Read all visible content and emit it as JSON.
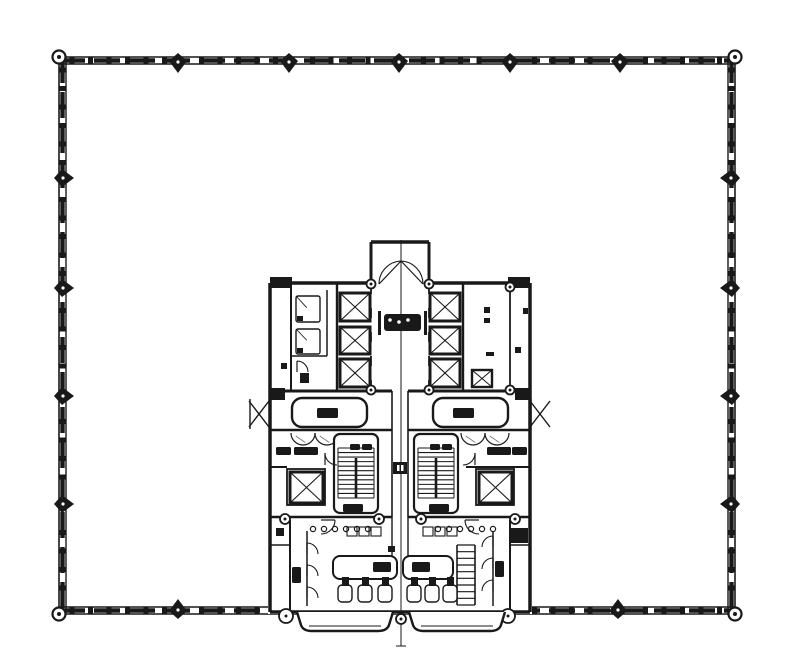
{
  "document": {
    "type": "architectural-floor-plan",
    "description": "Scanned typical office tower floor plan: square floor plate with curtain-wall perimeter and a bottom-center service core (elevator banks, stairs, restrooms)",
    "background": "#ffffff",
    "ink": "#191919",
    "light_ink": "#6f6f6f"
  },
  "perimeter": {
    "outer": {
      "x": 59,
      "y": 57,
      "w": 676,
      "h": 557
    },
    "band_inset": 7,
    "dash": {
      "len": 26,
      "gap": 9,
      "w": 4.4
    },
    "tick": {
      "spacing": 18.5,
      "w": 5,
      "h": 3.2
    },
    "corner_nodes": [
      [
        59,
        57
      ],
      [
        735,
        57
      ],
      [
        59,
        614
      ],
      [
        735,
        614
      ]
    ],
    "columns": {
      "top": [
        178,
        289,
        399,
        510,
        620
      ],
      "bottom": [
        178,
        618
      ],
      "left": [
        178,
        288,
        396,
        504
      ],
      "right": [
        178,
        288,
        396,
        504
      ]
    },
    "column_size": 9
  },
  "core": {
    "fill_rects": [
      [
        268,
        281,
        264,
        333
      ],
      [
        369,
        240,
        66,
        45
      ],
      [
        247,
        397,
        25,
        34
      ],
      [
        530,
        397,
        25,
        34
      ]
    ],
    "centerline": {
      "x": 401,
      "y1": 240,
      "y2": 646
    },
    "walls": [
      [
        270,
        283,
        371,
        283,
        3.5
      ],
      [
        429,
        283,
        530,
        283,
        3.5
      ],
      [
        270,
        283,
        270,
        612,
        3.5
      ],
      [
        530,
        283,
        530,
        612,
        3.5
      ],
      [
        270,
        612,
        530,
        612,
        3.5
      ],
      [
        371,
        242,
        371,
        284,
        3
      ],
      [
        429,
        242,
        429,
        284,
        3
      ],
      [
        371,
        242,
        429,
        242,
        3.5
      ],
      [
        291,
        283,
        291,
        391,
        2
      ],
      [
        327,
        290,
        327,
        356,
        1.5
      ],
      [
        291,
        356,
        327,
        356,
        1.5
      ],
      [
        337,
        283,
        337,
        391,
        2.4
      ],
      [
        463,
        283,
        463,
        391,
        2.4
      ],
      [
        510,
        283,
        510,
        391,
        1.8
      ],
      [
        270,
        391,
        392,
        391,
        3
      ],
      [
        408,
        391,
        530,
        391,
        3
      ],
      [
        270,
        430,
        392,
        430,
        2.6
      ],
      [
        408,
        430,
        530,
        430,
        2.6
      ],
      [
        392,
        391,
        392,
        517,
        1.6
      ],
      [
        408,
        391,
        408,
        517,
        1.6
      ],
      [
        270,
        467,
        287,
        467,
        2
      ],
      [
        466,
        467,
        530,
        467,
        2
      ],
      [
        270,
        517,
        392,
        517,
        2.6
      ],
      [
        408,
        517,
        530,
        517,
        2.6
      ],
      [
        290,
        520,
        290,
        612,
        2
      ],
      [
        307,
        531,
        307,
        606,
        1.5
      ],
      [
        493,
        531,
        493,
        606,
        1.5
      ],
      [
        510,
        520,
        510,
        612,
        2
      ],
      [
        270,
        545,
        290,
        545,
        1.5
      ],
      [
        510,
        545,
        530,
        545,
        1.5
      ],
      [
        392,
        517,
        392,
        556,
        1.4
      ],
      [
        408,
        517,
        408,
        556,
        1.4
      ]
    ],
    "dashed_walls": [
      [
        371,
        284,
        371,
        390,
        1.8,
        "10 14"
      ],
      [
        429,
        284,
        429,
        390,
        1.8,
        "10 14"
      ]
    ],
    "posts": [
      [
        270,
        277,
        22,
        11
      ],
      [
        508,
        277,
        22,
        11
      ],
      [
        270,
        388,
        15,
        12
      ],
      [
        515,
        388,
        15,
        12
      ],
      [
        509,
        528,
        19,
        15
      ]
    ],
    "rings": [
      [
        371,
        284,
        4.5
      ],
      [
        429,
        284,
        4.5
      ],
      [
        371,
        390,
        4.5
      ],
      [
        429,
        390,
        4.5
      ],
      [
        510,
        287,
        4.5
      ],
      [
        510,
        390,
        4.5
      ],
      [
        285,
        519,
        5
      ],
      [
        379,
        519,
        5
      ],
      [
        421,
        519,
        5
      ],
      [
        515,
        519,
        5
      ],
      [
        286,
        616,
        7
      ],
      [
        401,
        619,
        5
      ],
      [
        508,
        616,
        7
      ]
    ],
    "elevators": [
      [
        340,
        293,
        30,
        28
      ],
      [
        340,
        327,
        30,
        27
      ],
      [
        340,
        359,
        30,
        28
      ],
      [
        430,
        293,
        30,
        28
      ],
      [
        430,
        327,
        30,
        27
      ],
      [
        430,
        359,
        30,
        28
      ],
      [
        290,
        472,
        33,
        31
      ],
      [
        479,
        472,
        33,
        31
      ]
    ],
    "enclosures": [
      [
        287,
        469,
        38,
        36
      ],
      [
        476,
        469,
        38,
        36
      ]
    ],
    "shaft_panels": [
      [
        296,
        296,
        24,
        26
      ],
      [
        296,
        329,
        24,
        25
      ]
    ],
    "duct_xboxes": [
      [
        472,
        370,
        20,
        17
      ]
    ],
    "stairs": [
      {
        "x": 334,
        "y": 434,
        "w": 44,
        "h": 79,
        "tx1": 338,
        "tx2": 374,
        "ty1": 448,
        "ty2": 498,
        "n": 12
      },
      {
        "x": 414,
        "y": 434,
        "w": 44,
        "h": 79,
        "tx1": 418,
        "tx2": 454,
        "ty1": 448,
        "ty2": 498,
        "n": 12
      }
    ],
    "ladder": {
      "x": 457,
      "y": 545,
      "w": 18,
      "h": 60,
      "rungs": 9
    },
    "rounded_rooms": [
      [
        292,
        398,
        75,
        29
      ],
      [
        433,
        398,
        75,
        29
      ]
    ],
    "counters": [
      [
        333,
        556,
        64,
        23
      ],
      [
        403,
        556,
        50,
        23
      ]
    ],
    "toilets": {
      "y": 585,
      "w": 14,
      "h": 17,
      "xs": [
        338,
        358,
        378,
        407,
        425,
        443
      ]
    },
    "badge": {
      "bracket_l": [
        378,
        311,
        3,
        24
      ],
      "bracket_r": [
        424,
        311,
        3,
        24
      ],
      "inner": [
        384,
        314,
        37,
        17
      ],
      "dots": [
        [
          390,
          320
        ],
        [
          399,
          322
        ],
        [
          408,
          320
        ]
      ]
    },
    "labels": [
      [
        317,
        408,
        21,
        10
      ],
      [
        453,
        408,
        21,
        10
      ],
      [
        276,
        447,
        15,
        8
      ],
      [
        294,
        447,
        24,
        8
      ],
      [
        487,
        447,
        24,
        8
      ],
      [
        512,
        447,
        15,
        8
      ],
      [
        350,
        444,
        10,
        6
      ],
      [
        362,
        444,
        10,
        6
      ],
      [
        430,
        444,
        10,
        6
      ],
      [
        442,
        444,
        10,
        6
      ],
      [
        343,
        504,
        20,
        8
      ],
      [
        429,
        504,
        20,
        8
      ],
      [
        292,
        567,
        9,
        16
      ],
      [
        495,
        561,
        9,
        16
      ],
      [
        373,
        562,
        18,
        10
      ],
      [
        412,
        562,
        18,
        10
      ]
    ],
    "specks": [
      [
        484,
        307,
        6,
        6
      ],
      [
        484,
        318,
        6,
        5
      ],
      [
        515,
        347,
        6,
        6
      ],
      [
        486,
        352,
        8,
        4
      ],
      [
        281,
        363,
        6,
        6
      ],
      [
        300,
        373,
        9,
        10
      ],
      [
        276,
        528,
        8,
        8
      ],
      [
        388,
        546,
        7,
        6
      ],
      [
        523,
        308,
        5,
        6
      ]
    ],
    "small_stalls": [
      [
        347,
        527,
        10,
        9
      ],
      [
        359,
        527,
        10,
        9
      ],
      [
        371,
        527,
        10,
        9
      ],
      [
        423,
        527,
        10,
        9
      ],
      [
        435,
        527,
        10,
        9
      ],
      [
        447,
        527,
        10,
        9
      ]
    ],
    "dotted_rows": [
      {
        "y": 529,
        "x0": 313,
        "n": 6,
        "step": 11,
        "r": 2.6
      },
      {
        "y": 529,
        "x0": 438,
        "n": 6,
        "step": 11,
        "r": 2.6
      }
    ],
    "door_arcs": [
      {
        "d": "M401,261 A23 23 0 0 0 379,284",
        "leaf": [
          379,
          284,
          401,
          261
        ]
      },
      {
        "d": "M401,261 A23 23 0 0 1 423,284",
        "leaf": [
          423,
          284,
          401,
          261
        ]
      },
      {
        "d": "M297,361 A11 11 0 0 1 308,372",
        "leaf": [
          297,
          361,
          297,
          372
        ]
      },
      {
        "d": "M325,453 A12 12 0 0 0 337,465",
        "leaf": [
          325,
          453,
          325,
          465
        ]
      },
      {
        "d": "M475,453 A12 12 0 0 1 463,465",
        "leaf": [
          475,
          453,
          475,
          465
        ]
      },
      {
        "d": "M335,520 A14 14 0 0 1 321,534",
        "leaf": [
          335,
          520,
          321,
          520
        ]
      },
      {
        "d": "M465,520 A14 14 0 0 0 479,534",
        "leaf": [
          465,
          520,
          479,
          520
        ]
      },
      {
        "d": "M307,543 A11 11 0 0 1 318,554",
        "leaf": [
          307,
          543,
          307,
          554
        ]
      },
      {
        "d": "M307,565 A11 11 0 0 1 318,576",
        "leaf": [
          307,
          565,
          307,
          576
        ]
      },
      {
        "d": "M307,587 A11 11 0 0 1 318,598",
        "leaf": [
          307,
          587,
          307,
          598
        ]
      },
      {
        "d": "M493,536 A11 11 0 0 0 482,547",
        "leaf": [
          493,
          536,
          493,
          547
        ]
      },
      {
        "d": "M493,558 A11 11 0 0 0 482,569",
        "leaf": [
          493,
          558,
          493,
          569
        ]
      },
      {
        "d": "M493,580 A11 11 0 0 0 482,591",
        "leaf": [
          493,
          580,
          493,
          591
        ]
      }
    ],
    "vent_arcs": [
      [
        303,
        433,
        12
      ],
      [
        327,
        433,
        12
      ],
      [
        473,
        433,
        12
      ],
      [
        497,
        433,
        12
      ]
    ],
    "canopies": [
      {
        "x": 249,
        "y": 399,
        "w": 20,
        "h": 30
      },
      {
        "x": 530,
        "y": 399,
        "w": 20,
        "h": 30
      }
    ],
    "bulges": [
      {
        "x": 297,
        "y": 612,
        "w": 96,
        "h": 19
      },
      {
        "x": 409,
        "y": 612,
        "w": 96,
        "h": 19
      }
    ],
    "junction_box": [
      393,
      462,
      14,
      12
    ]
  }
}
